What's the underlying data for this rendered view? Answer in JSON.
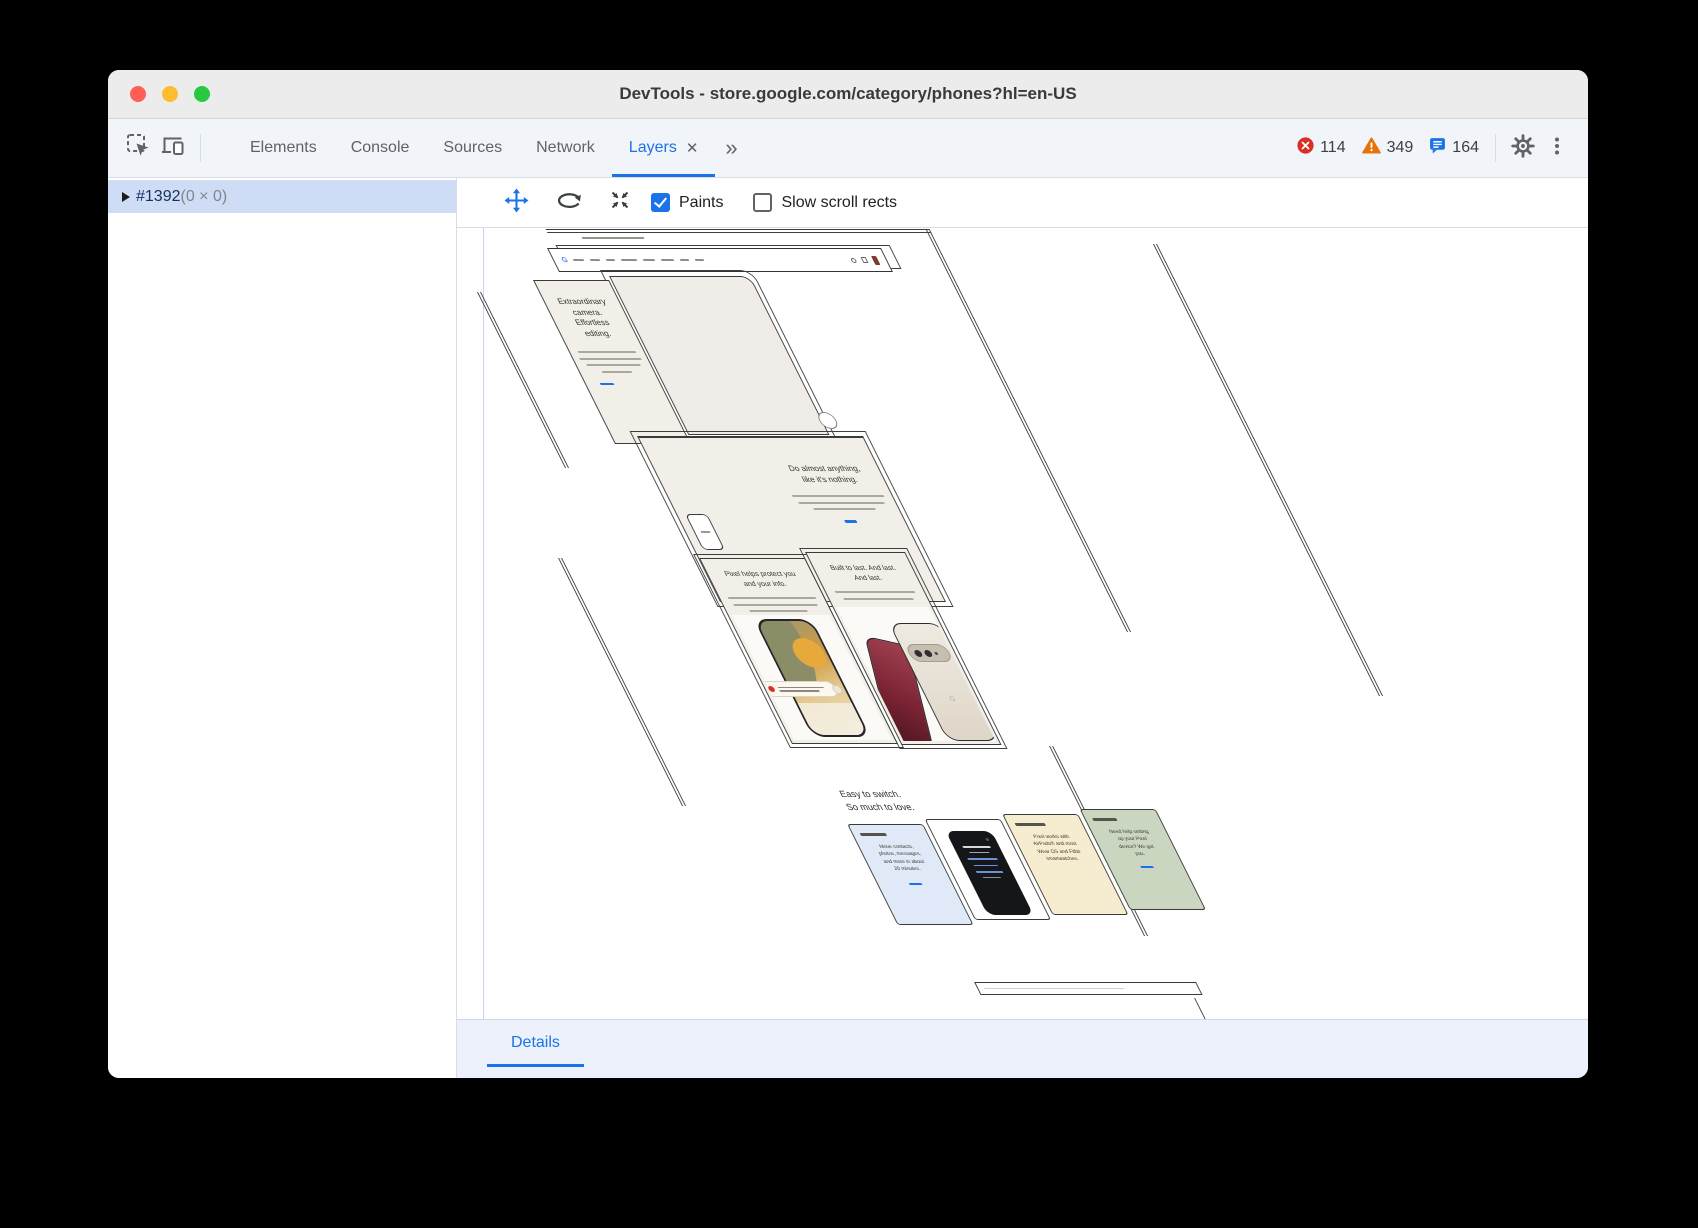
{
  "window": {
    "title": "DevTools - store.google.com/category/phones?hl=en-US"
  },
  "toolbar": {
    "tabs": [
      "Elements",
      "Console",
      "Sources",
      "Network",
      "Layers"
    ],
    "active_tab": "Layers",
    "close_label": "✕",
    "overflow_label": "»",
    "errors": "114",
    "warnings": "349",
    "messages": "164"
  },
  "sidebar": {
    "layer_id": "#1392",
    "layer_size": "(0 × 0)"
  },
  "layers_toolbar": {
    "paints": "Paints",
    "slow_scroll": "Slow scroll rects",
    "paints_checked": true,
    "slow_scroll_checked": false
  },
  "details": {
    "label": "Details"
  },
  "page": {
    "store_logo": "G",
    "phone_logo": "G",
    "hero_card": {
      "lines": [
        "Extraordinary",
        "camera.",
        "Effortless",
        "editing."
      ]
    },
    "anything": {
      "lines": [
        "Do almost anything,",
        "like it's nothing."
      ]
    },
    "protect": {
      "lines": [
        "Pixel helps protect you",
        "and your info."
      ]
    },
    "durable": {
      "lines": [
        "Built to last. And last.",
        "And last."
      ]
    },
    "switch_heading": {
      "lines": [
        "Easy to switch.",
        "So much to love."
      ]
    },
    "card_move": {
      "lines": [
        "Move contacts,",
        "photos, messages,",
        "and more in about",
        "20 minutes."
      ]
    },
    "card_airpods": {
      "lines": [
        "Pixel works with",
        "AirPods® and most",
        "Wear OS and Fitbit",
        "smartwatches."
      ]
    },
    "card_setup": {
      "lines": [
        "Need help setting",
        "up your Pixel",
        "device? We got",
        "you."
      ]
    }
  },
  "colors": {
    "accent": "#1a73e8",
    "error": "#d93025",
    "warning": "#e8710a",
    "selection": "#cedcf6"
  }
}
